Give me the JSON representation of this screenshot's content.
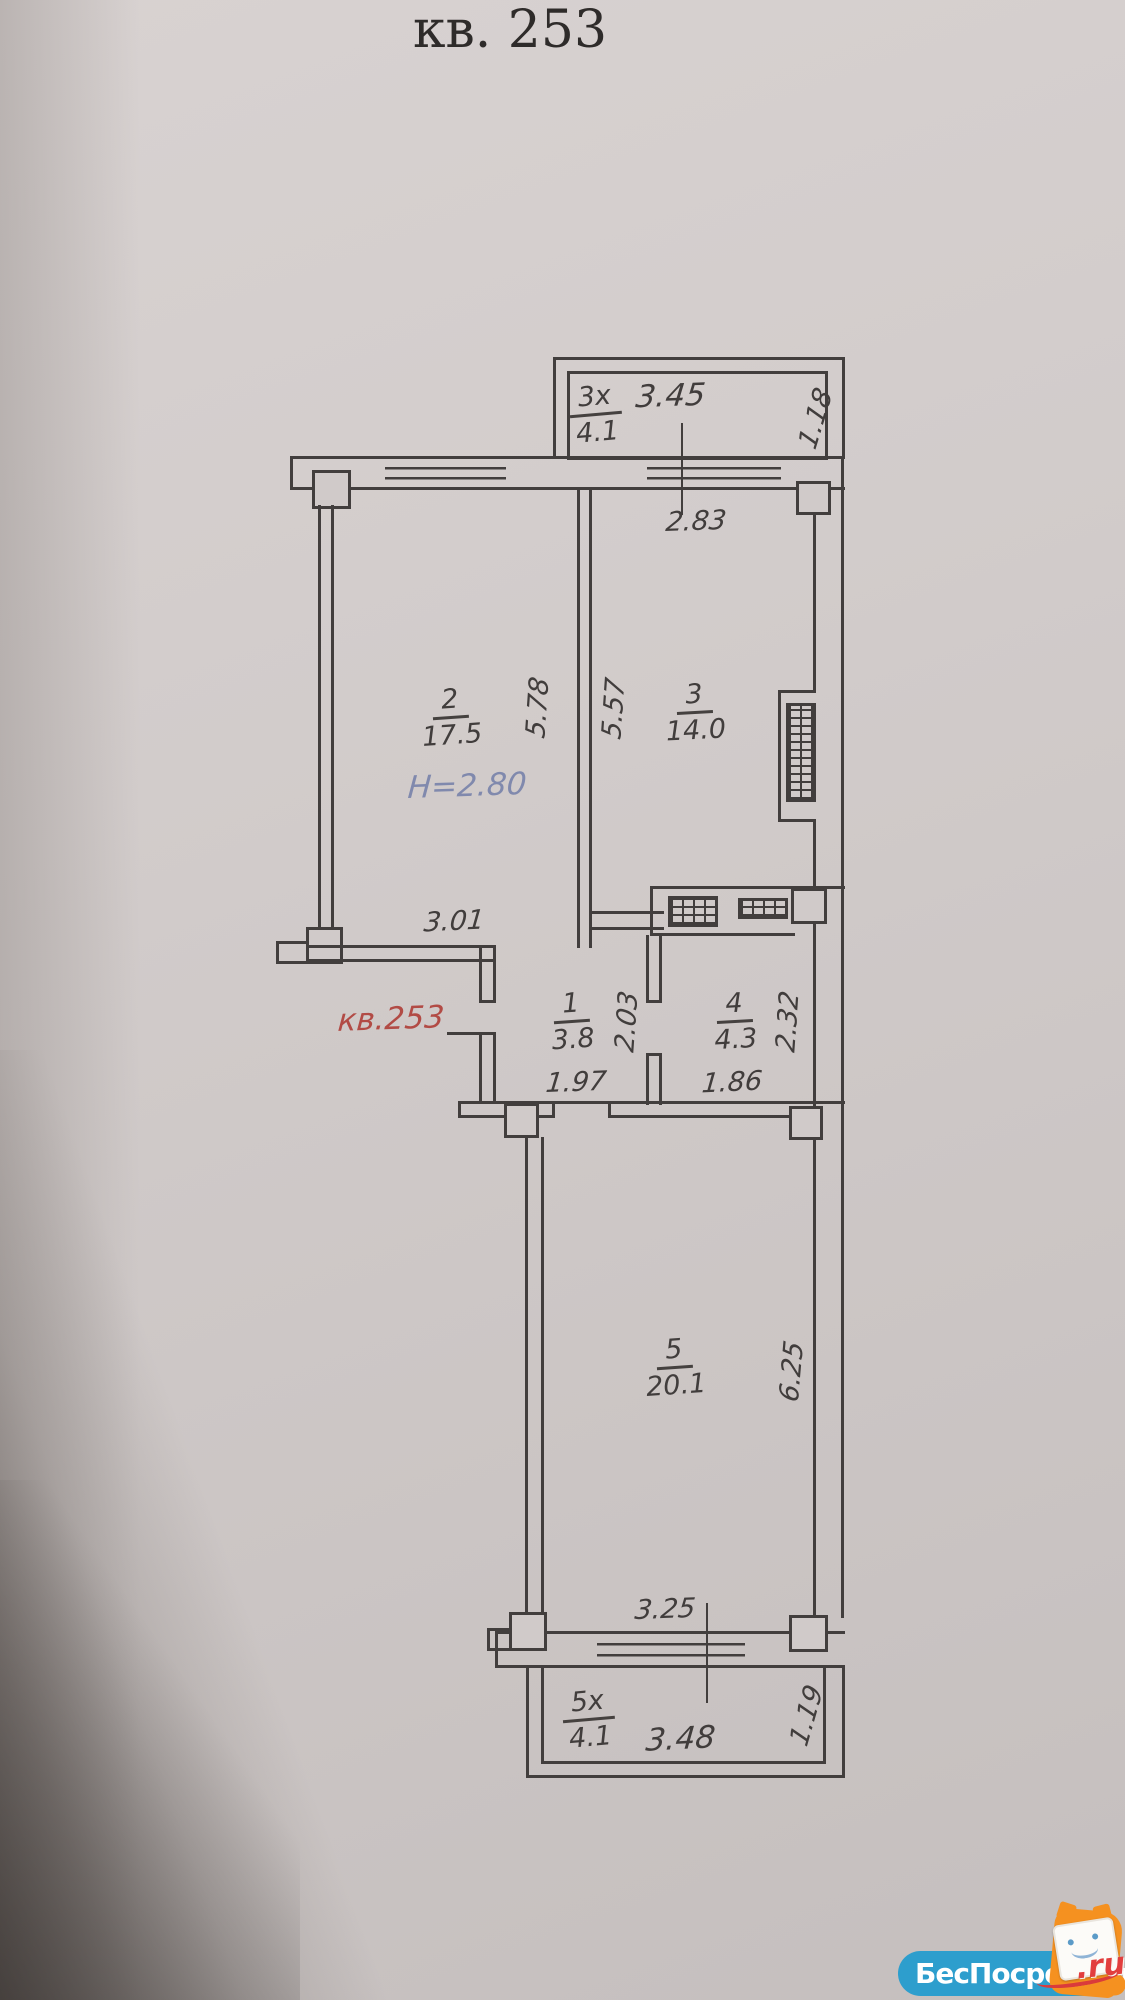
{
  "title": "кв. 253",
  "plan": {
    "apartment_mark": "кв.253",
    "ceiling_height": "Н=2.80",
    "rooms": {
      "r1": {
        "num": "1",
        "area": "3.8"
      },
      "r2": {
        "num": "2",
        "area": "17.5"
      },
      "r3": {
        "num": "3",
        "area": "14.0"
      },
      "r4": {
        "num": "4",
        "area": "4.3"
      },
      "r5": {
        "num": "5",
        "area": "20.1"
      }
    },
    "balconies": {
      "top": {
        "num": "3х",
        "area": "4.1",
        "length": "3.45",
        "depth": "1.18"
      },
      "bottom": {
        "num": "5х",
        "area": "4.1",
        "length": "3.48",
        "depth": "1.19"
      }
    },
    "dims": {
      "room3_win": "2.83",
      "room2_h": "5.78",
      "room3_h": "5.57",
      "room2_w": "3.01",
      "room1_h": "2.03",
      "room1_w": "1.97",
      "room4_h": "2.32",
      "room4_w": "1.86",
      "room5_h": "6.25",
      "room5_w": "3.25"
    },
    "colors": {
      "ink": "#423e3d",
      "red_mark": "#b24b45",
      "blue_note": "#8089ad",
      "watermark_blue": "#2d9ecd",
      "watermark_red": "#e23e3e",
      "mascot_orange": "#f59120"
    }
  },
  "watermark": {
    "brand": "БесПосредника",
    "tld": ".ru"
  }
}
